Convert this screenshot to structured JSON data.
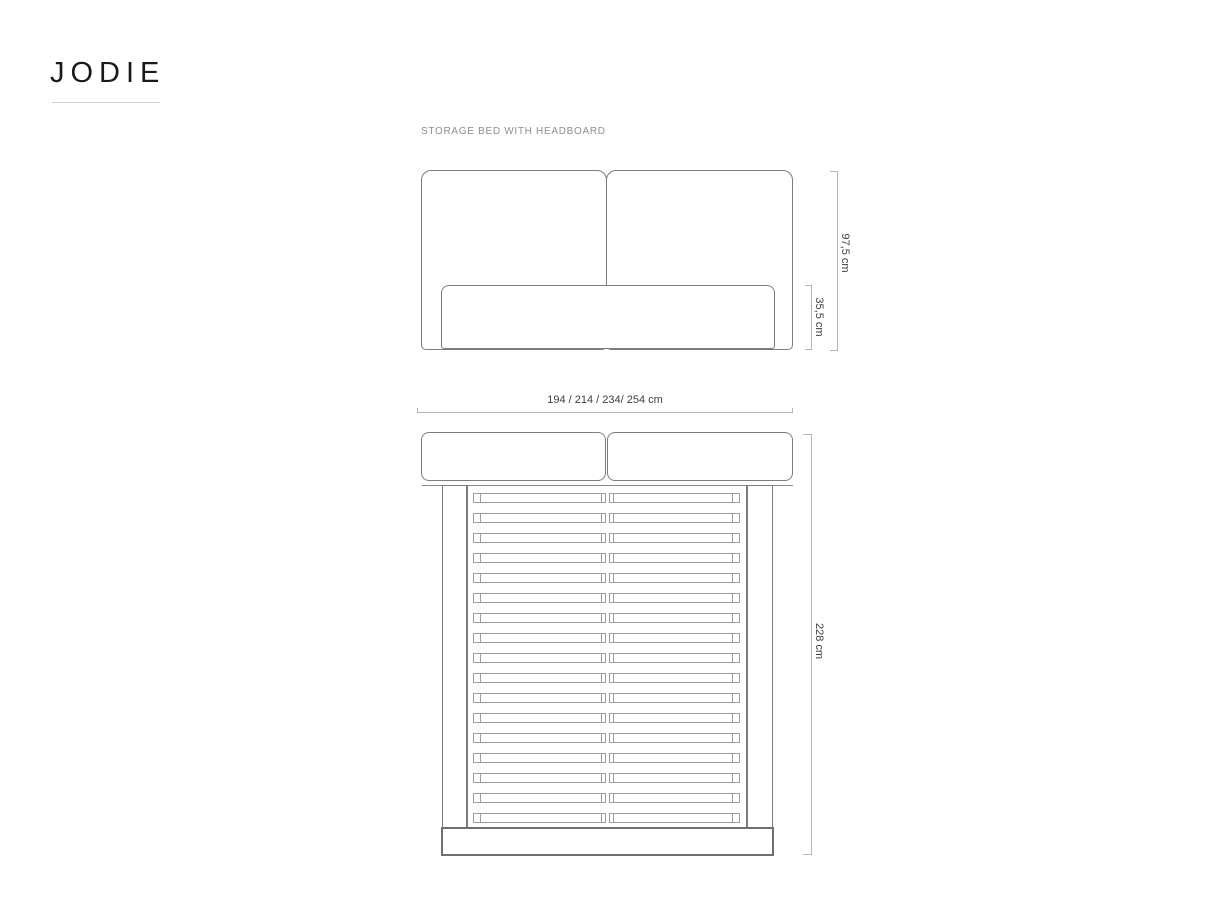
{
  "brand": {
    "logo_text": "JODIE"
  },
  "subtitle": "STORAGE BED WITH HEADBOARD",
  "dimensions": {
    "headboard_height": "97,5 cm",
    "base_height": "35,5 cm",
    "widths": "194 / 214 / 234/ 254 cm",
    "length": "228 cm"
  },
  "views": {
    "front": {
      "name": "front view",
      "headboard_panels": 2
    },
    "top": {
      "name": "top view",
      "headboard_panels": 2,
      "slat_count": 17,
      "slat_columns": 2
    }
  },
  "colors": {
    "outline": "#7d7d7d",
    "slat": "#9d9d9d",
    "dim_line": "#b5b5b5",
    "dim_text": "#3f3f3f",
    "subtitle_text": "#8e8e8e",
    "logo": "#1a1a1a"
  }
}
